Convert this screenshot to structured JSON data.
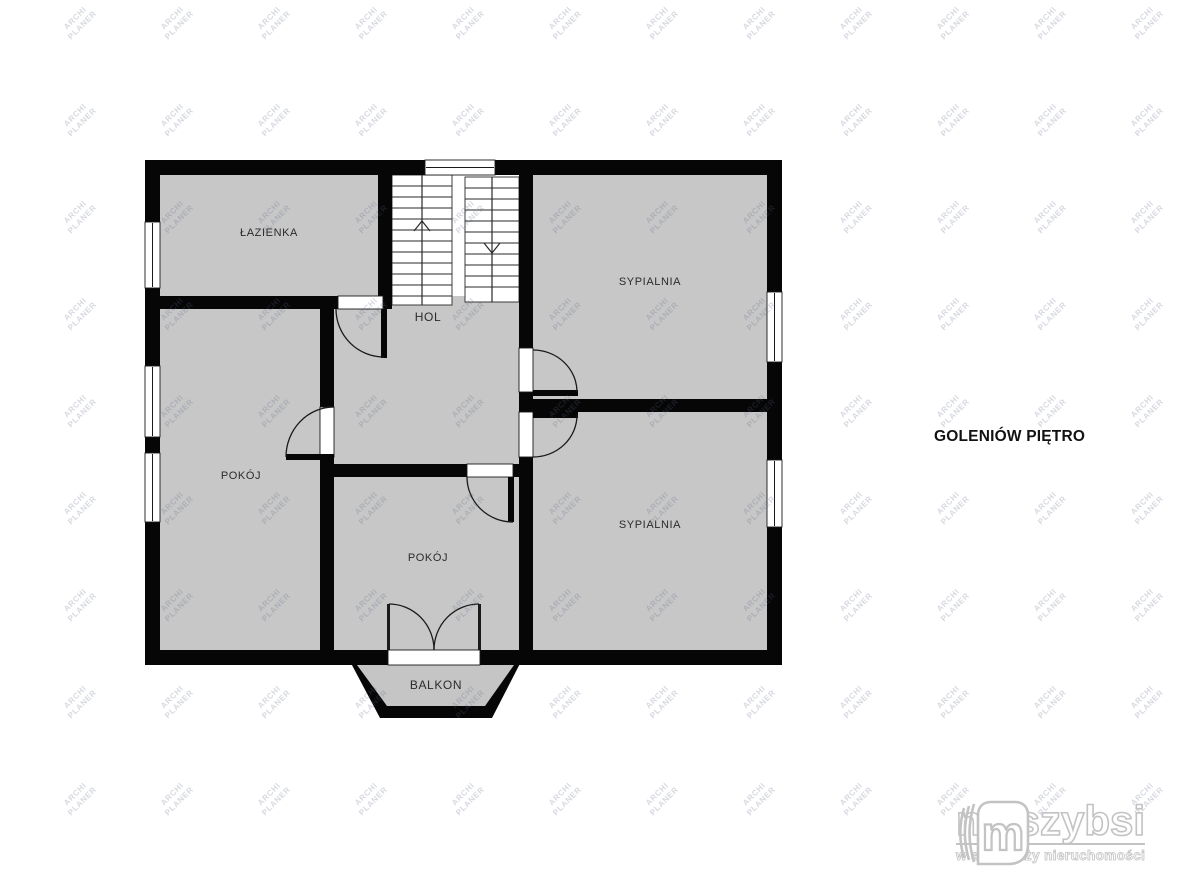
{
  "title": "GOLENIÓW PIĘTRO",
  "watermark": {
    "line1": "ARCHI",
    "line2": "PLANER"
  },
  "plan": {
    "rooms": [
      {
        "id": "bathroom",
        "label": "ŁAZIENKA"
      },
      {
        "id": "hall",
        "label": "HOL"
      },
      {
        "id": "bedroom-top",
        "label": "SYPIALNIA"
      },
      {
        "id": "bedroom-bottom",
        "label": "SYPIALNIA"
      },
      {
        "id": "room-left",
        "label": "POKÓJ"
      },
      {
        "id": "room-middle",
        "label": "POKÓJ"
      },
      {
        "id": "balcony",
        "label": "BALKON"
      }
    ],
    "stairs": {
      "up_arrow": "up",
      "down_arrow": "down"
    }
  },
  "logo": {
    "brand": "najszybsi",
    "tagline": "w sprzedaży nieruchomości",
    "icon": "m-monogram-icon"
  },
  "colors": {
    "background": "#ffffff",
    "room_fill": "#c7c7c7",
    "balcony_fill": "#c5c5c5",
    "wall": "#060606",
    "label_text": "#2b2b2b",
    "title_text": "#121212",
    "watermark_text": "rgba(90,105,130,0.25)",
    "logo_gray": "#c3c3c3"
  }
}
